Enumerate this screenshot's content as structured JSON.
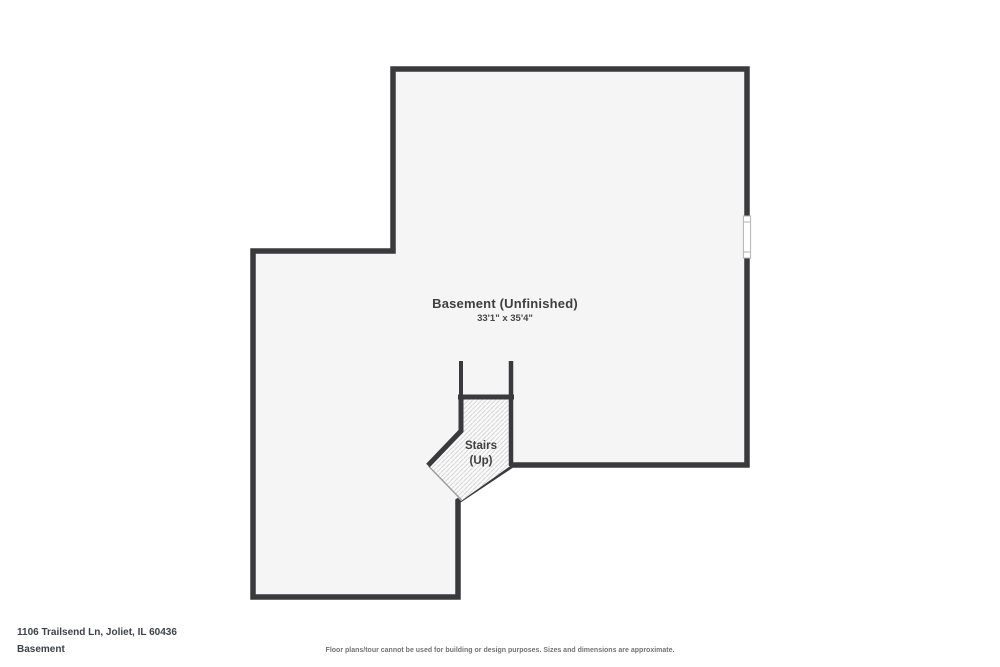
{
  "floorplan": {
    "room": {
      "label": "Basement (Unfinished)",
      "dimensions": "33'1\" x 35'4\""
    },
    "stairs": {
      "line1": "Stairs",
      "line2": "(Up)"
    }
  },
  "footer": {
    "address": "1106 Trailsend Ln, Joliet, IL 60436",
    "floor_name": "Basement",
    "disclaimer": "Floor plans/tour cannot be used for building or design purposes. Sizes and dimensions are approximate."
  },
  "colors": {
    "wall": "#3a3a3c",
    "room_fill": "#f5f5f6",
    "hatch_bg": "#fafafa",
    "hatch_line": "#d7d7d7",
    "open_edge": "#9a9a9a",
    "window_frame": "#b3b3b3",
    "window_fill": "#ffffff"
  }
}
